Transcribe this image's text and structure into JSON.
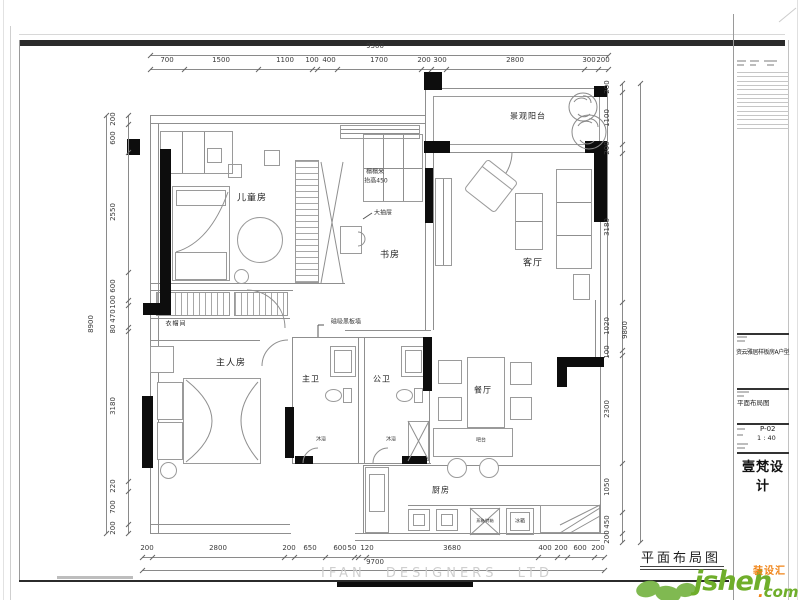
{
  "page": {
    "drawing_label": "平面布局图",
    "watermark": "IFAN DESIGNERS LTD"
  },
  "title_block": {
    "project_name": "资云雅居样板房A户型",
    "drawing_title": "平面布局图",
    "sheet_number": "P-02",
    "scale": "1 : 40",
    "company": "壹梵设计"
  },
  "logo": {
    "brand": "jsheh",
    "dot": ".",
    "tld": "com",
    "tagline": "装设汇",
    "green": "#6fae2b",
    "orange": "#f08519"
  },
  "rooms": [
    {
      "id": "kids-room",
      "label": "儿童房",
      "x": 252,
      "y": 197,
      "size": 9
    },
    {
      "id": "study",
      "label": "书房",
      "x": 390,
      "y": 254,
      "size": 9
    },
    {
      "id": "living-room",
      "label": "客厅",
      "x": 533,
      "y": 262,
      "size": 9
    },
    {
      "id": "balcony",
      "label": "景观阳台",
      "x": 528,
      "y": 116,
      "size": 8
    },
    {
      "id": "master-bedroom",
      "label": "主人房",
      "x": 231,
      "y": 362,
      "size": 9
    },
    {
      "id": "master-bath",
      "label": "主卫",
      "x": 311,
      "y": 379,
      "size": 8
    },
    {
      "id": "public-bath",
      "label": "公卫",
      "x": 382,
      "y": 379,
      "size": 8
    },
    {
      "id": "dining-room",
      "label": "餐厅",
      "x": 483,
      "y": 390,
      "size": 8
    },
    {
      "id": "kitchen",
      "label": "厨房",
      "x": 441,
      "y": 490,
      "size": 8
    },
    {
      "id": "cloakroom",
      "label": "衣帽间",
      "x": 176,
      "y": 323,
      "size": 6
    }
  ],
  "annotations": [
    {
      "id": "tatami",
      "label": "榻榻米",
      "x": 375,
      "y": 171,
      "size": 6
    },
    {
      "id": "tatami-height",
      "label": "抬高450",
      "x": 376,
      "y": 180,
      "size": 6
    },
    {
      "id": "big-drawer",
      "label": "大抽屉",
      "x": 383,
      "y": 212,
      "size": 6
    },
    {
      "id": "magnetic-blackboard-wall",
      "label": "磁吸黑板墙",
      "x": 346,
      "y": 321,
      "size": 6
    },
    {
      "id": "bar-counter",
      "label": "吧台",
      "x": 481,
      "y": 440,
      "size": 5
    },
    {
      "id": "shower-master",
      "label": "沐浴",
      "x": 321,
      "y": 439,
      "size": 5
    },
    {
      "id": "shower-public",
      "label": "沐浴",
      "x": 391,
      "y": 439,
      "size": 5
    },
    {
      "id": "steam-oven",
      "label": "蒸箱/烤箱",
      "x": 485,
      "y": 521,
      "size": 4
    },
    {
      "id": "fridge",
      "label": "冰箱",
      "x": 520,
      "y": 521,
      "size": 5
    }
  ],
  "dimensions": [
    {
      "id": "top-overall",
      "o": "h",
      "pos": 55,
      "a": 150,
      "b": 608,
      "lp": 42,
      "ticks": [
        150,
        608
      ],
      "labels": [
        [
          "9300",
          375
        ]
      ]
    },
    {
      "id": "top-segments",
      "o": "h",
      "pos": 69,
      "a": 150,
      "b": 608,
      "lp": 56,
      "ticks": [
        150,
        184,
        258,
        312,
        317,
        337,
        421,
        431,
        446,
        584,
        598,
        608
      ],
      "labels": [
        [
          "700",
          167
        ],
        [
          "1500",
          221
        ],
        [
          "1100",
          285
        ],
        [
          "100",
          312
        ],
        [
          "400",
          329
        ],
        [
          "1700",
          379
        ],
        [
          "200",
          424
        ],
        [
          "300",
          440
        ],
        [
          "2800",
          515
        ],
        [
          "300",
          589
        ],
        [
          "200",
          603
        ]
      ]
    },
    {
      "id": "bottom-segments",
      "o": "h",
      "pos": 557,
      "a": 142,
      "b": 604,
      "lp": 544,
      "ticks": [
        142,
        152,
        284,
        294,
        325,
        354,
        358,
        366,
        538,
        557,
        567,
        594,
        604
      ],
      "labels": [
        [
          "200",
          147
        ],
        [
          "2800",
          218
        ],
        [
          "200",
          289
        ],
        [
          "650",
          310
        ],
        [
          "600",
          340
        ],
        [
          "50",
          352
        ],
        [
          "120",
          367
        ],
        [
          "3680",
          452
        ],
        [
          "400",
          545
        ],
        [
          "200",
          561
        ],
        [
          "600",
          580
        ],
        [
          "200",
          598
        ]
      ]
    },
    {
      "id": "bottom-overall",
      "o": "h",
      "pos": 570,
      "a": 142,
      "b": 604,
      "lp": 558,
      "ticks": [
        142,
        604
      ],
      "labels": [
        [
          "9700",
          375
        ]
      ]
    },
    {
      "id": "left-segments",
      "o": "v",
      "pos": 128,
      "a": 115,
      "b": 533,
      "lp": 113,
      "ticks": [
        115,
        124,
        152,
        272,
        300,
        305,
        327,
        331,
        481,
        491,
        524,
        533
      ],
      "labels": [
        [
          "200",
          119
        ],
        [
          "600",
          138
        ],
        [
          "2550",
          212
        ],
        [
          "600",
          286
        ],
        [
          "100",
          302
        ],
        [
          "470",
          316
        ],
        [
          "80",
          329
        ],
        [
          "3180",
          406
        ],
        [
          "220",
          486
        ],
        [
          "700",
          507
        ],
        [
          "200",
          528
        ]
      ]
    },
    {
      "id": "left-overall",
      "o": "v",
      "pos": 106,
      "a": 115,
      "b": 533,
      "lp": 91,
      "ticks": [
        115,
        533
      ],
      "labels": [
        [
          "8900",
          324
        ]
      ]
    },
    {
      "id": "right-segments",
      "o": "v",
      "pos": 622,
      "a": 83,
      "b": 542,
      "lp": 607,
      "ticks": [
        83,
        92,
        144,
        153,
        302,
        350,
        355,
        463,
        512,
        533,
        542
      ],
      "labels": [
        [
          "200",
          87
        ],
        [
          "1100",
          118
        ],
        [
          "200",
          148
        ],
        [
          "3180",
          227
        ],
        [
          "1020",
          326
        ],
        [
          "100",
          352
        ],
        [
          "2300",
          409
        ],
        [
          "1050",
          487
        ],
        [
          "450",
          522
        ],
        [
          "200",
          537
        ]
      ]
    },
    {
      "id": "right-overall",
      "o": "v",
      "pos": 640,
      "a": 83,
      "b": 542,
      "lp": 625,
      "ticks": [
        83,
        542
      ],
      "labels": [
        [
          "9800",
          330
        ]
      ]
    }
  ]
}
